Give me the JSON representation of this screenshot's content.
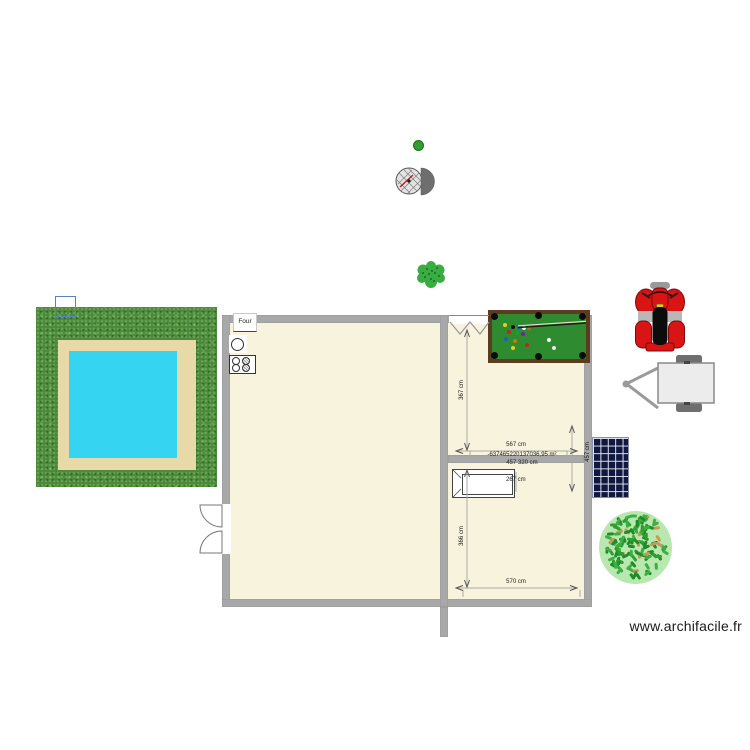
{
  "app": {
    "watermark": "www.archifacile.fr"
  },
  "kitchen": {
    "oven_label": "Four"
  },
  "dimensions": {
    "top_room_width": "567 cm",
    "top_room_height": "367 cm",
    "right_side_height": "457 cm",
    "area_glitch": "-637465220137036,95 m²",
    "wall_dim": "457 320 cm",
    "bed_width": "267 cm",
    "bottom_room_width": "570 cm",
    "bottom_room_height": "366 cm"
  },
  "billiard": {
    "felt_color": "#2e8b2f",
    "frame_color": "#5d3b1e",
    "balls": [
      {
        "x": 11,
        "y": 9,
        "c": "#e6cf1d"
      },
      {
        "x": 19,
        "y": 11,
        "c": "#101010"
      },
      {
        "x": 25,
        "y": 11,
        "c": "#2858c8"
      },
      {
        "x": 30,
        "y": 12,
        "c": "#f2f2f2"
      },
      {
        "x": 35,
        "y": 12,
        "c": "#b5741c"
      },
      {
        "x": 15,
        "y": 16,
        "c": "#cc2020"
      },
      {
        "x": 23,
        "y": 17,
        "c": "#18a038"
      },
      {
        "x": 29,
        "y": 18,
        "c": "#7a1ca8"
      },
      {
        "x": 12,
        "y": 23,
        "c": "#2858c8"
      },
      {
        "x": 21,
        "y": 25,
        "c": "#d07800"
      },
      {
        "x": 33,
        "y": 29,
        "c": "#cc2020"
      },
      {
        "x": 55,
        "y": 24,
        "c": "#f2f2f2"
      },
      {
        "x": 19,
        "y": 32,
        "c": "#e6cf1d"
      },
      {
        "x": 60,
        "y": 32,
        "c": "#e8e8e8"
      }
    ]
  },
  "large_bush": {
    "leaf_count": 130,
    "leaf_colors": [
      "#2f9e33",
      "#3cb043",
      "#1f8c28",
      "#c59a58"
    ]
  },
  "colors": {
    "wall": "#a8a8a8",
    "room_fill": "#f8f3dd",
    "grass": "#4a8a38",
    "deck": "#e7d9a8",
    "pool_water": "#35d5f2",
    "solar_panel": "#11173f",
    "quad_red": "#d81414"
  }
}
